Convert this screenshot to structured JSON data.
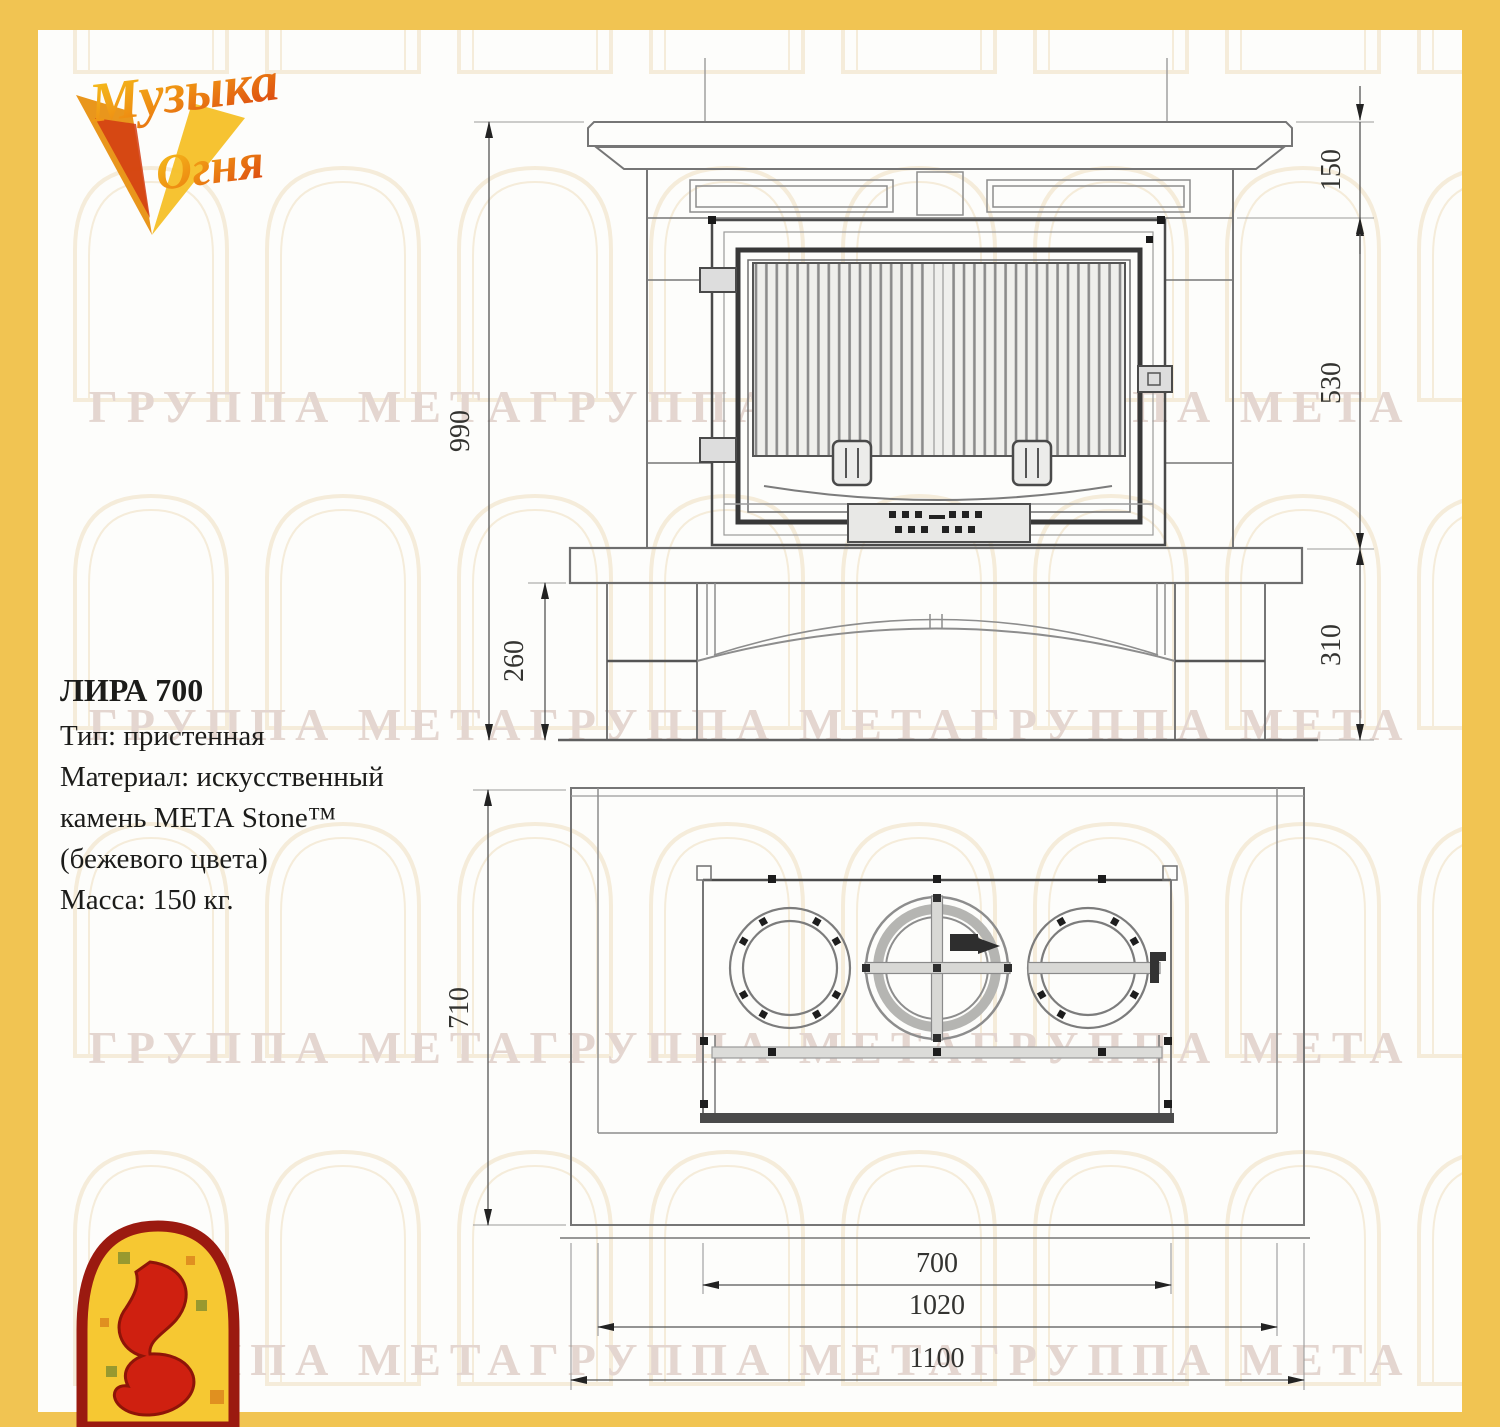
{
  "page": {
    "frame_color": "#f1c452",
    "canvas_color": "#fdfdfb",
    "line_color": "#767676",
    "dark_line_color": "#3f3f3f",
    "watermark_color": "#e4d6d0",
    "arch_watermark_color": "#f4ead6"
  },
  "brand": {
    "logo_top_line1": "Музыка",
    "logo_top_line2": "Огня",
    "logo_accent_gold": "#f0a818",
    "logo_accent_red": "#cf2010"
  },
  "product": {
    "title": "ЛИРА 700",
    "specs": [
      "Тип: пристенная",
      "Материал: искусственный",
      "камень МЕТА Stone™",
      "(бежевого цвета)",
      "Масса: 150 кг."
    ]
  },
  "watermark": {
    "text": "ГРУППА МЕТАГРУППА МЕТАГРУППА МЕТА"
  },
  "drawing": {
    "views": [
      "front-elevation",
      "plan"
    ],
    "units": "mm",
    "dims": {
      "shelf_height": "150",
      "firebox_height": "530",
      "base_height": "310",
      "total_height": "990",
      "plinth_height": "260",
      "depth": "710",
      "firebox_width": "700",
      "inner_width": "1020",
      "total_width": "1100"
    }
  }
}
